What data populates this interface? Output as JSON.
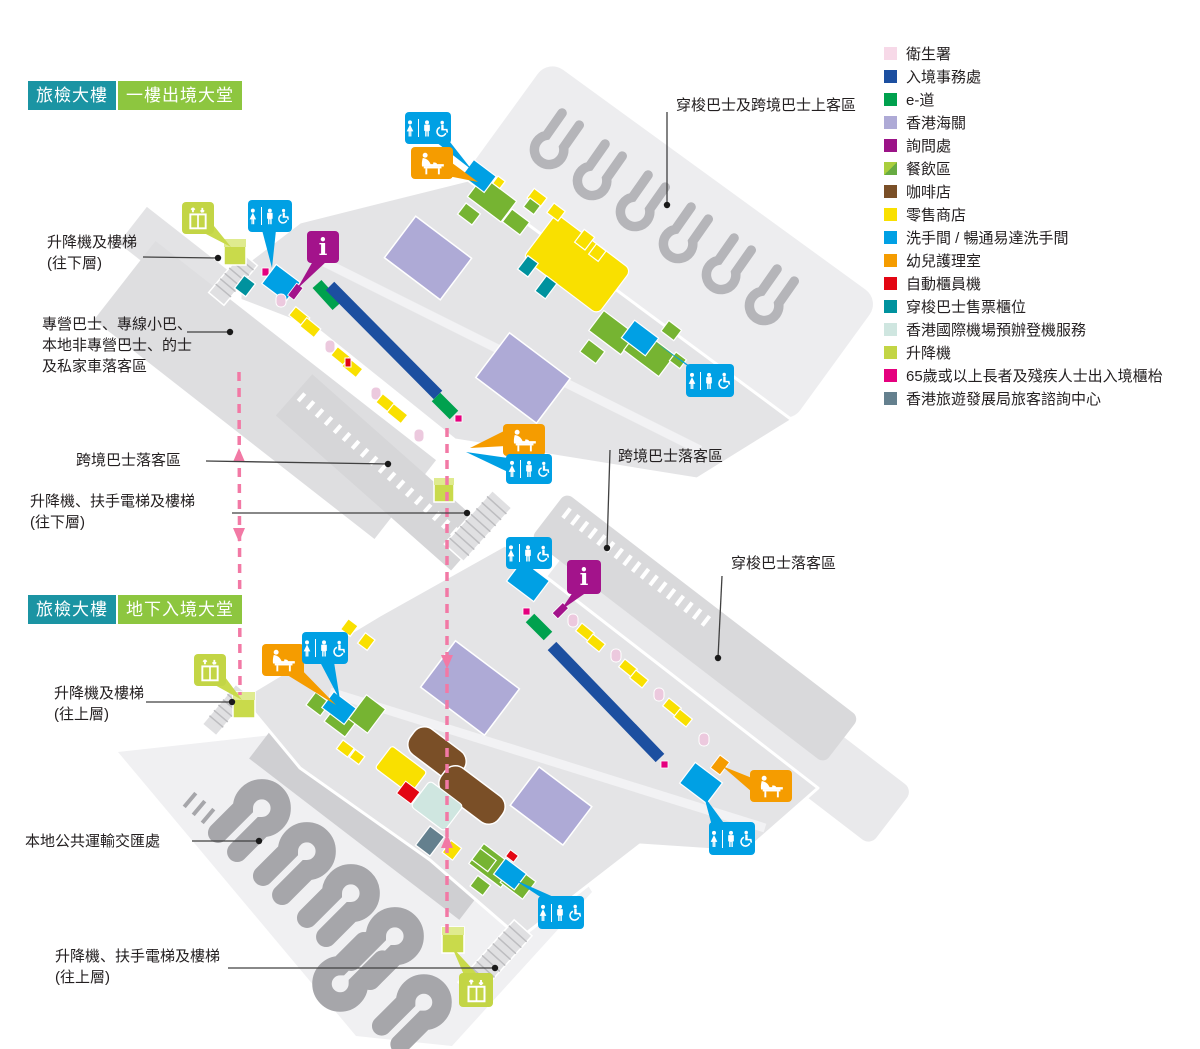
{
  "titles": {
    "building": "旅檢大樓",
    "upper_hall": "一樓出境大堂",
    "lower_hall": "地下入境大堂"
  },
  "legend": {
    "items": [
      {
        "label": "衛生署",
        "color": "#f7d9e8",
        "swatch_style": "background:#f7d9e8"
      },
      {
        "label": "入境事務處",
        "color": "#1c4fa0",
        "swatch_style": "background:#1c4fa0"
      },
      {
        "label": "e-道",
        "color": "#00a14e",
        "swatch_style": "background:#00a14e"
      },
      {
        "label": "香港海關",
        "color": "#aeaad6",
        "swatch_style": "background:#aeaad6"
      },
      {
        "label": "詢問處",
        "color": "#9b1387",
        "swatch_style": "background:#9b1387"
      },
      {
        "label": "餐飲區",
        "color": "#76b432",
        "swatch_style": "background:linear-gradient(135deg,#a9ce3d 50%,#67ab42 50%)"
      },
      {
        "label": "咖啡店",
        "color": "#7a4f27",
        "swatch_style": "background:#7a4f27"
      },
      {
        "label": "零售商店",
        "color": "#f9e000",
        "swatch_style": "background:#f9e000"
      },
      {
        "label": "洗手間 / 暢通易達洗手間",
        "color": "#00a0e4",
        "swatch_style": "background:#00a0e4"
      },
      {
        "label": "幼兒護理室",
        "color": "#f59c00",
        "swatch_style": "background:#f59c00"
      },
      {
        "label": "自動櫃員機",
        "color": "#e30613",
        "swatch_style": "background:#e30613"
      },
      {
        "label": "穿梭巴士售票櫃位",
        "color": "#00929e",
        "swatch_style": "background:#00929e"
      },
      {
        "label": "香港國際機場預辦登機服務",
        "color": "#cfe6e0",
        "swatch_style": "background:#cfe6e0"
      },
      {
        "label": "升降機",
        "color": "#c3d545",
        "swatch_style": "background:#c3d545"
      },
      {
        "label": "65歲或以上長者及殘疾人士出入境櫃枱",
        "color": "#e5007e",
        "swatch_style": "background:#e5007e"
      },
      {
        "label": "香港旅遊發展局旅客諮詢中心",
        "color": "#64808e",
        "swatch_style": "background:#64808e"
      }
    ]
  },
  "callouts": {
    "boarding": "穿梭巴士及跨境巴士上客區",
    "lift_stairs_down": [
      "升降機及樓梯",
      "(往下層)"
    ],
    "franchised": [
      "專營巴士、專線小巴、",
      "本地非專營巴士、的士",
      "及私家車落客區"
    ],
    "crossborder_left": "跨境巴士落客區",
    "lift_esc_down": [
      "升降機、扶手電梯及樓梯",
      "(往下層)"
    ],
    "crossborder_right": "跨境巴士落客區",
    "shuttle_dropoff": "穿梭巴士落客區",
    "lift_stairs_up": [
      "升降機及樓梯",
      "(往上層)"
    ],
    "pti": "本地公共運輸交匯處",
    "lift_esc_up": [
      "升降機、扶手電梯及樓梯",
      "(往上層)"
    ]
  },
  "icons": {
    "info_glyph": "i"
  },
  "colors": {
    "title_teal": "#1b94a3",
    "title_green": "#8dc63f",
    "badge_toilet": "#00a0e4",
    "badge_baby_care": "#f59c00",
    "badge_info": "#a3138b",
    "badge_lift": "#c3d545",
    "connector_dash_pink": "#f279a5",
    "leader_line": "#404040"
  }
}
